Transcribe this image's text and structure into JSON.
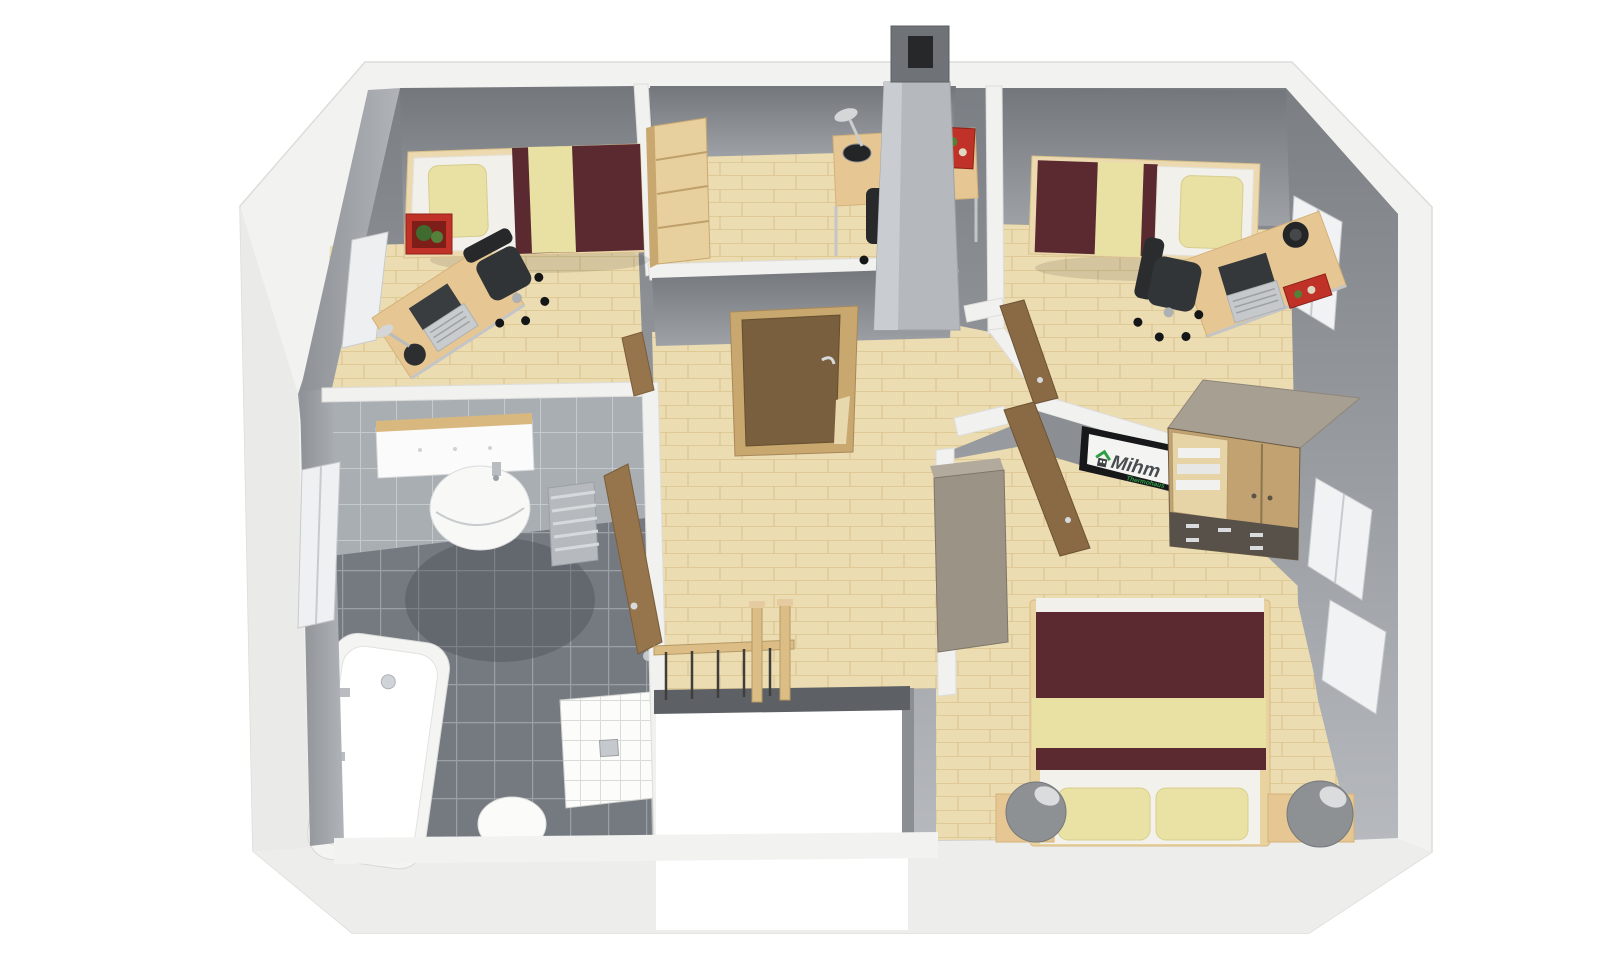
{
  "scene": {
    "title": "3D cutaway floor plan render - upper storey",
    "view": "birds-eye perspective, white exterior shell, no roof"
  },
  "branding": {
    "brand": "Mihm",
    "subtitle": "Thermohaus",
    "brand_color": "#474c4f",
    "subtitle_color": "#2f9e44"
  },
  "palette": {
    "shell_white": "#f2f2f0",
    "shell_shade": "#eaeae8",
    "wall_gray_dark": "#7b7f84",
    "wall_gray_light": "#b6b9bd",
    "wall_top_white": "#f1f1ef",
    "floor_parquet": "#ecdcb2",
    "parquet_line": "#dfca96",
    "bath_floor_tile": "#757a80",
    "bath_wall_tile": "#a9aeb3",
    "blanket_maroon": "#5a2a30",
    "pillow_yellow": "#e8e1a3",
    "mattress_white": "#f2f0ea",
    "desk_wood": "#e6c793",
    "door_wood": "#8a6a44",
    "frame_wood": "#c9a86f",
    "wardrobe_wood": "#c2a271",
    "cabinet_taupe": "#9c9387",
    "chimney_gray": "#b5b9bd",
    "accent_red": "#c03228",
    "chair_black": "#2b2d2f",
    "lamp_gray": "#8e9194"
  },
  "rooms": [
    {
      "name": "bedroom-top-left",
      "furniture": [
        "single-bed",
        "yellow-pillow",
        "maroon-blanket",
        "desk",
        "laptop",
        "desk-lamp",
        "office-chair",
        "red-planter-box",
        "window"
      ]
    },
    {
      "name": "office-top-middle",
      "furniture": [
        "shelf-cabinet",
        "desk",
        "desk-lamp",
        "red-box",
        "office-chair",
        "chimney"
      ]
    },
    {
      "name": "bedroom-top-right",
      "furniture": [
        "single-bed",
        "yellow-pillow",
        "maroon-blanket",
        "desk",
        "laptop",
        "desk-lamp",
        "red-box",
        "office-chair",
        "window"
      ]
    },
    {
      "name": "bathroom",
      "furniture": [
        "bathtub",
        "bath-faucets",
        "shower-tray",
        "toilet",
        "washbasin",
        "mirror",
        "towel-radiator",
        "window",
        "open-door"
      ]
    },
    {
      "name": "hallway",
      "furniture": [
        "staircase-opening",
        "wooden-railing",
        "newel-posts",
        "open-door-to-office"
      ]
    },
    {
      "name": "master-bedroom",
      "furniture": [
        "double-bed",
        "two-yellow-pillows",
        "nightstand-left",
        "nightstand-right",
        "two-bedside-lamps",
        "wardrobe-with-drawers",
        "tall-cabinet",
        "tv-screen-with-logo",
        "two-windows",
        "open-door"
      ]
    }
  ]
}
